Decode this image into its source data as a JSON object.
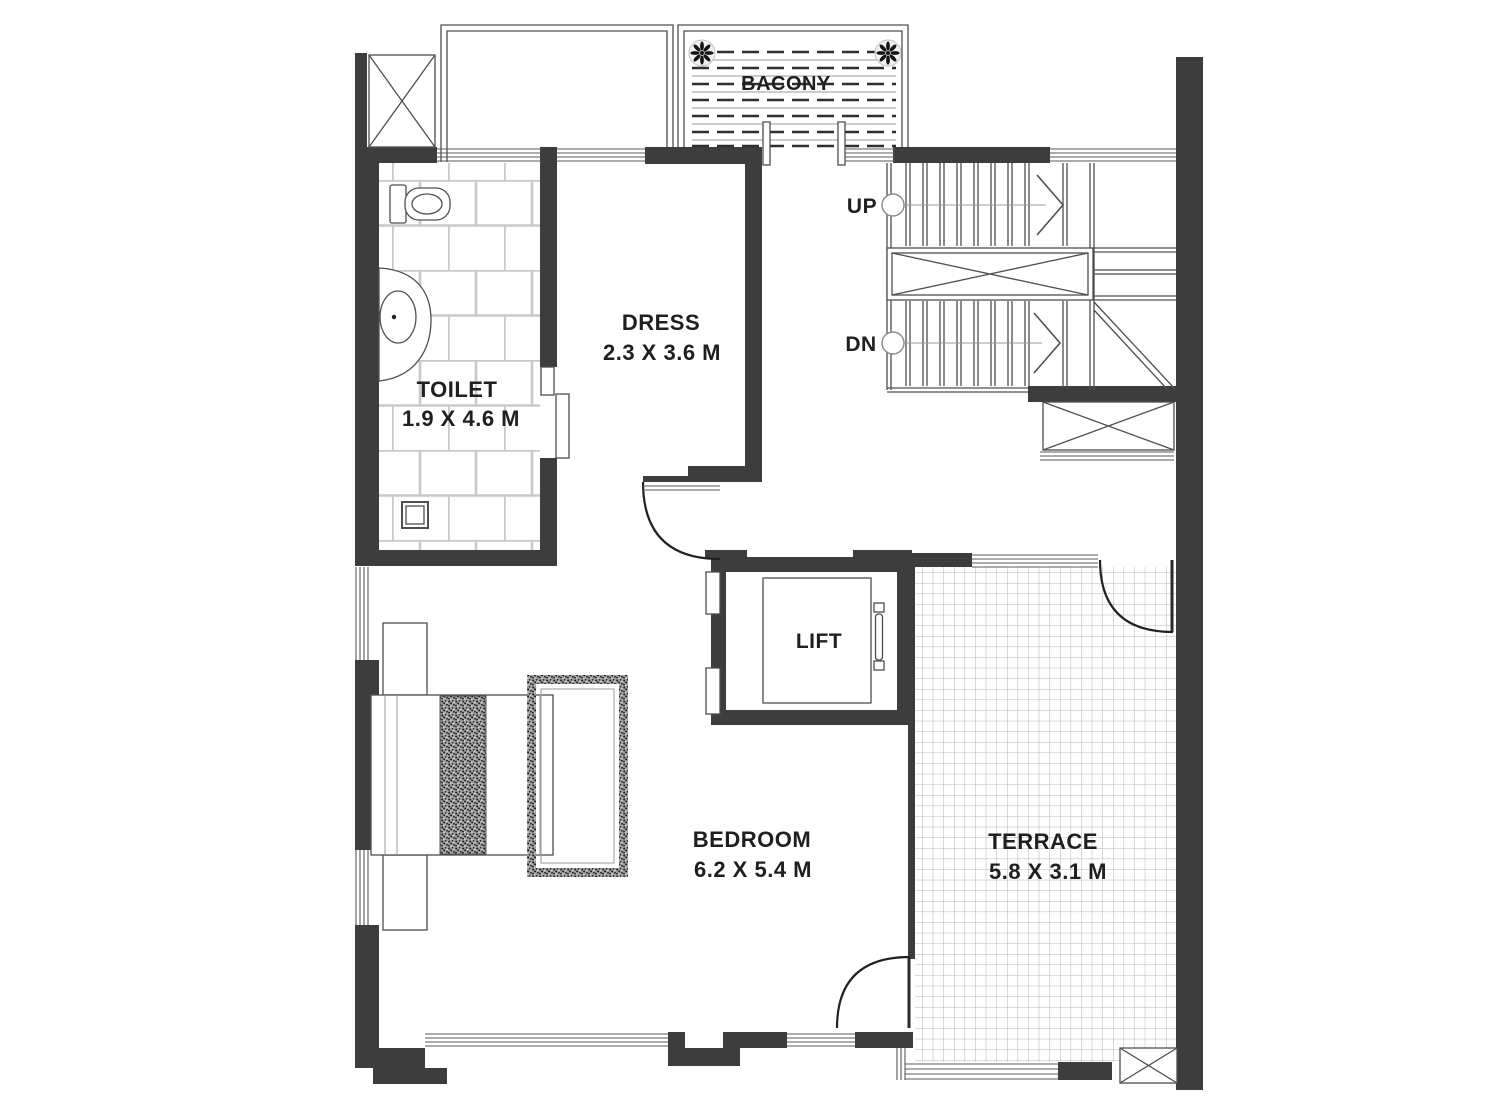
{
  "plan": {
    "rooms": {
      "balcony": {
        "label": "BACONY"
      },
      "toilet": {
        "label": "TOILET",
        "dimensions": "1.9 X 4.6 M"
      },
      "dress": {
        "label": "DRESS",
        "dimensions": "2.3 X 3.6 M"
      },
      "bedroom": {
        "label": "BEDROOM",
        "dimensions": "6.2 X 5.4 M"
      },
      "terrace": {
        "label": "TERRACE",
        "dimensions": "5.8 X 3.1 M"
      },
      "lift": {
        "label": "LIFT"
      }
    },
    "stairs": {
      "up": "UP",
      "down": "DN"
    },
    "fixtures": {
      "wc": "water-closet",
      "basin": "wash-basin",
      "drain": "floor-drain",
      "bed": "double-bed",
      "bench": "foot-bench",
      "planters": "potted-plant"
    }
  },
  "colors": {
    "background": "#ffffff",
    "wall": "#3d3d3d",
    "line": "#4f4f4f",
    "line_light": "#9a9a9a",
    "tile_line": "#c9c9c9",
    "grid_line": "#9b9b9b",
    "dash_line": "#2e2e2e",
    "text": "#1f1f1f"
  }
}
